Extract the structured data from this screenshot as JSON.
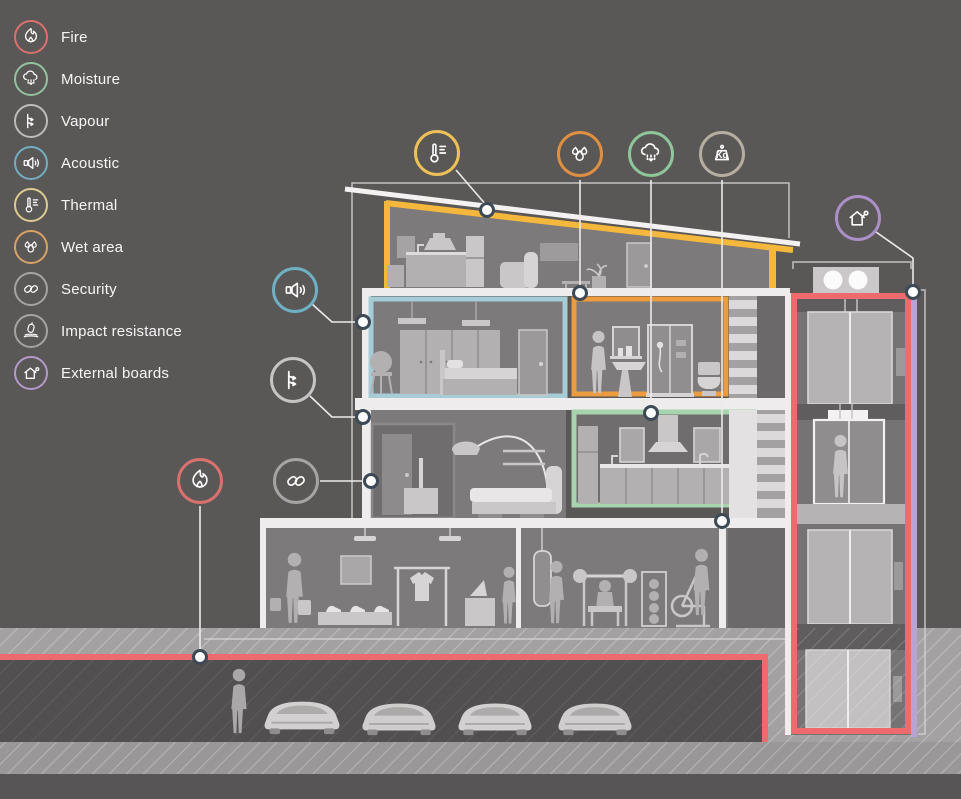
{
  "title": "Building performance zones cross-section diagram",
  "legend": {
    "items": [
      {
        "label": "Fire",
        "icon": "fire-icon",
        "color": "#d9716f"
      },
      {
        "label": "Moisture",
        "icon": "moisture-icon",
        "color": "#92c39e"
      },
      {
        "label": "Vapour",
        "icon": "vapour-icon",
        "color": "#bdbbbb"
      },
      {
        "label": "Acoustic",
        "icon": "acoustic-icon",
        "color": "#72aec0"
      },
      {
        "label": "Thermal",
        "icon": "thermal-icon",
        "color": "#decb90"
      },
      {
        "label": "Wet area",
        "icon": "wet-area-icon",
        "color": "#d8a266"
      },
      {
        "label": "Security",
        "icon": "security-icon",
        "color": "#a5a3a3"
      },
      {
        "label": "Impact resistance",
        "icon": "impact-resistance-icon",
        "color": "#a5a3a3"
      },
      {
        "label": "External boards",
        "icon": "external-boards-icon",
        "color": "#b29aca"
      }
    ]
  },
  "callouts": [
    {
      "name": "thermal",
      "icon": "thermal-icon",
      "color": "#ecc258"
    },
    {
      "name": "wet-area",
      "icon": "wet-area-icon",
      "color": "#de8f41"
    },
    {
      "name": "moisture",
      "icon": "moisture-icon",
      "color": "#8ec69a"
    },
    {
      "name": "weight",
      "icon": "weight-kg-icon",
      "color": "#b5ad9f",
      "text": "Kg"
    },
    {
      "name": "acoustic",
      "icon": "acoustic-icon",
      "color": "#6fb0c3"
    },
    {
      "name": "vapour",
      "icon": "vapour-icon",
      "color": "#c6c4c4"
    },
    {
      "name": "security",
      "icon": "security-icon",
      "color": "#a5a3a3"
    },
    {
      "name": "fire",
      "icon": "fire-icon",
      "color": "#d9716f"
    },
    {
      "name": "external-boards",
      "icon": "external-boards-icon",
      "color": "#ab8fc7"
    }
  ],
  "palette": {
    "background": "#5a5757",
    "room_interior": "#7c7a7a",
    "slab_white": "#eeecec",
    "fire_red": "#ed6b6c",
    "acoustic_blue": "#a6ccd8",
    "wet_area_orange": "#ec9b41",
    "moisture_green": "#a8d4ad",
    "thermal_yellow": "#f5b83d",
    "external_boards_purple": "#b7a3d6"
  }
}
